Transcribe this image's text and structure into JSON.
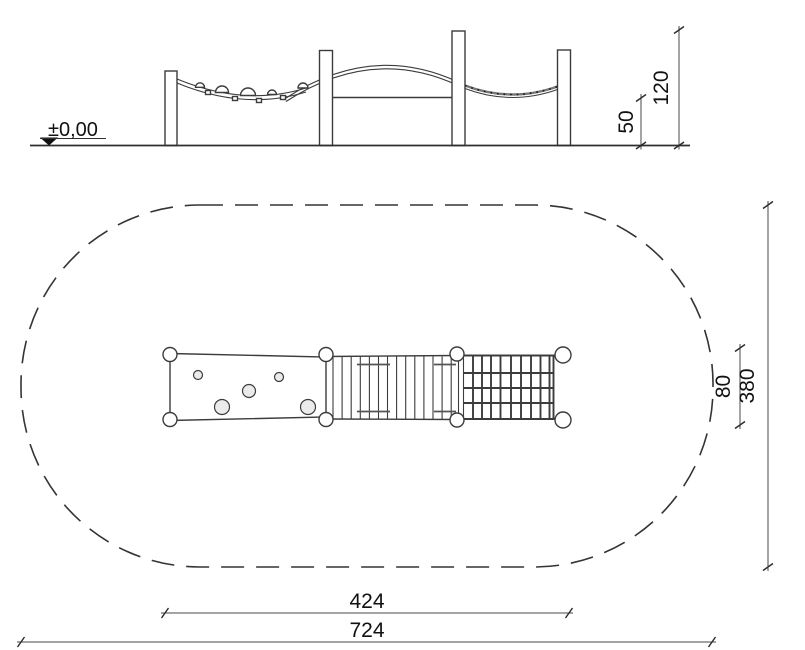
{
  "drawing": {
    "type": "playground-equipment-technical-drawing",
    "views": [
      "elevation",
      "plan"
    ]
  },
  "elevation": {
    "datum_label": "±0,00",
    "dims": {
      "bar_height": "50",
      "total_height": "120"
    }
  },
  "plan": {
    "safety_zone_style": "dashed-stadium-outline",
    "dims": {
      "equipment_length": "424",
      "zone_length": "724",
      "equipment_width": "80",
      "zone_width": "380"
    }
  },
  "colors": {
    "line": "#3c3c3c",
    "dim_line": "#4a4a4a",
    "text": "#111111",
    "knob_fill": "#ebebeb",
    "background": "#ffffff"
  }
}
